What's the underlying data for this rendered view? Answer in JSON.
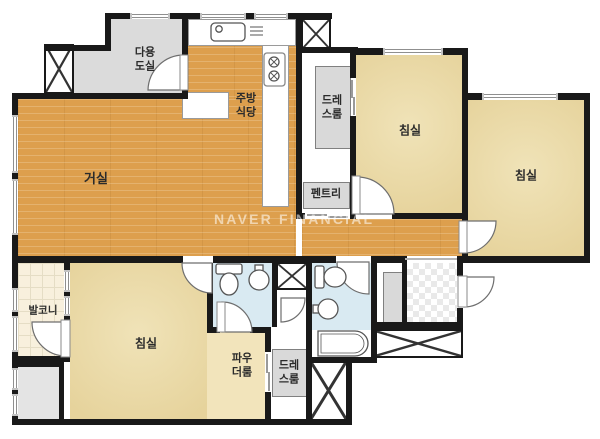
{
  "watermark": "NAVER FINANCIAL",
  "rooms": {
    "living": "거실",
    "kitchen_dining": "주방\n식당",
    "utility": "다용\n도실",
    "dressroom_top": "드레\n스룸",
    "pantry": "펜트리",
    "bedroom_top": "침실",
    "bedroom_right": "침실",
    "bedroom_bottom": "침실",
    "balcony": "발코니",
    "powder_room": "파우\n더룸",
    "dressroom_bottom": "드레\n스룸"
  },
  "colors": {
    "wall": "#191919",
    "wood_floor": "#dd9f4d",
    "bedroom_floor": "#ecdcab",
    "bathroom_floor": "#d9eaf2",
    "utility_gray": "#dbdbdb",
    "watermark": "rgba(255,255,255,0.55)"
  },
  "icons": {
    "kitchen_sink": "sink-icon",
    "stove": "stove-burners-icon",
    "toilets": "toilet-icon",
    "basins": "washbasin-icon",
    "bathtub": "bathtub-icon",
    "shafts": "shaft-x-icon"
  }
}
